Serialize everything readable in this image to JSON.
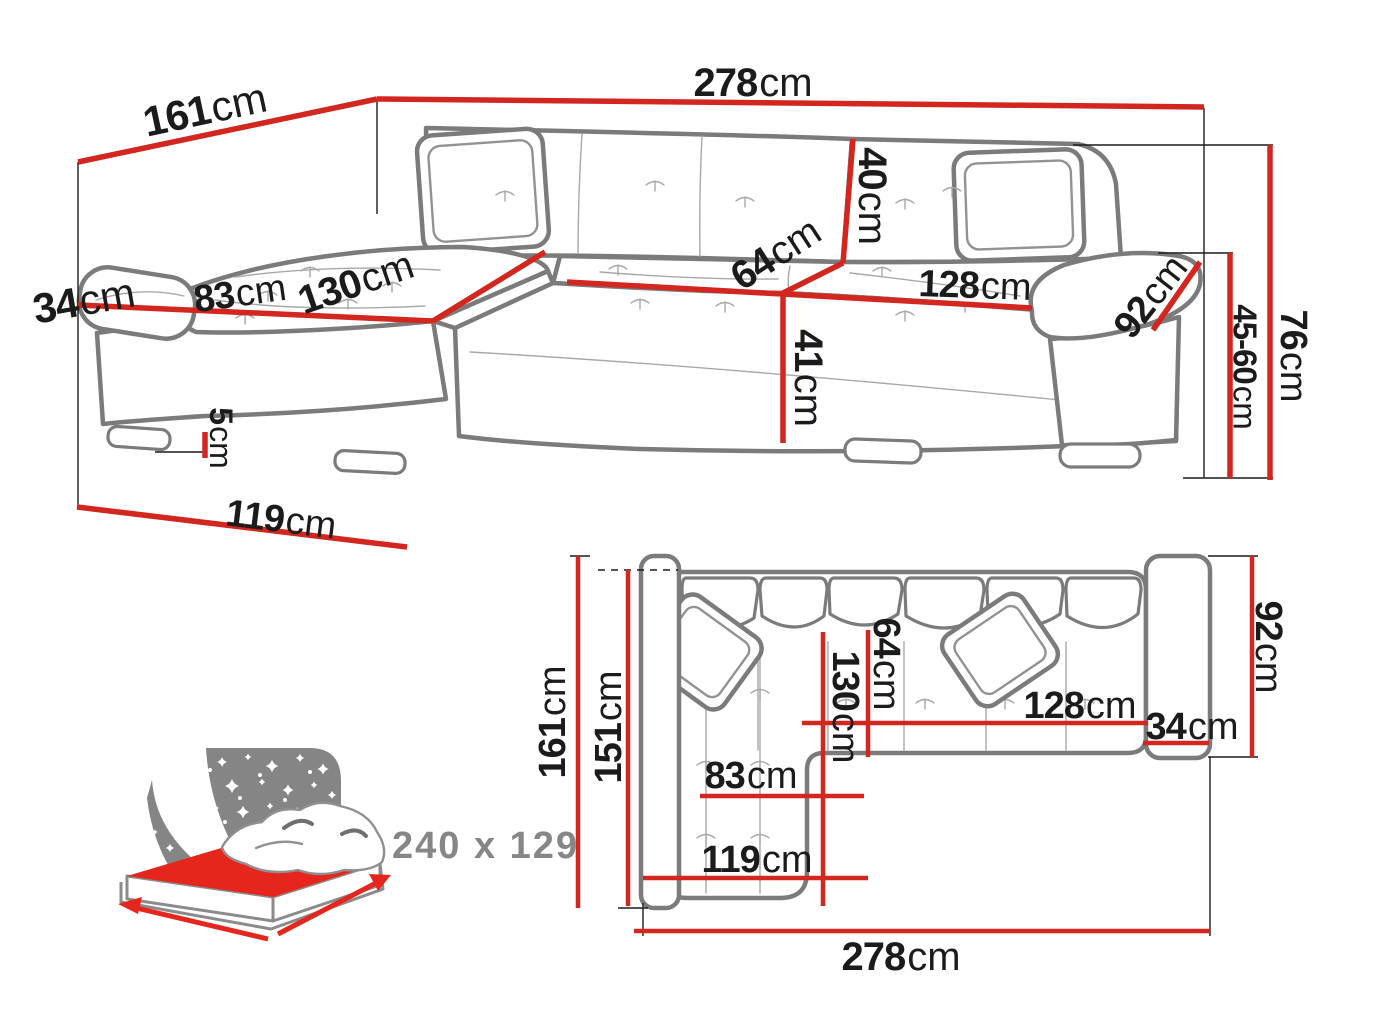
{
  "diagram_title": "corner-sofa-dimensions-diagram",
  "colors": {
    "dimension_red": "#d2261f",
    "outline_gray": "#7b7b7b",
    "seam_gray": "#a8a8a8",
    "label_black": "#1b1b1b",
    "icon_gray": "#858585",
    "icon_red": "#e6261c"
  },
  "dims_perspective": {
    "d161": {
      "num": "161",
      "unit": "cm"
    },
    "d278": {
      "num": "278",
      "unit": "cm"
    },
    "d34": {
      "num": "34",
      "unit": "cm"
    },
    "d83": {
      "num": "83",
      "unit": "cm"
    },
    "d130": {
      "num": "130",
      "unit": "cm"
    },
    "d40": {
      "num": "40",
      "unit": "cm"
    },
    "d64": {
      "num": "64",
      "unit": "cm"
    },
    "d41": {
      "num": "41",
      "unit": "cm"
    },
    "d128": {
      "num": "128",
      "unit": "cm"
    },
    "d92": {
      "num": "92",
      "unit": "cm"
    },
    "d76": {
      "num": "76",
      "unit": "cm"
    },
    "d45_60": {
      "num": "45-60",
      "unit": "cm"
    },
    "d5": {
      "num": "5",
      "unit": "cm"
    },
    "d119": {
      "num": "119",
      "unit": "cm"
    }
  },
  "dims_plan": {
    "d161": {
      "num": "161",
      "unit": "cm"
    },
    "d151": {
      "num": "151",
      "unit": "cm"
    },
    "d130": {
      "num": "130",
      "unit": "cm"
    },
    "d64": {
      "num": "64",
      "unit": "cm"
    },
    "d128": {
      "num": "128",
      "unit": "cm"
    },
    "d34": {
      "num": "34",
      "unit": "cm"
    },
    "d92": {
      "num": "92",
      "unit": "cm"
    },
    "d83": {
      "num": "83",
      "unit": "cm"
    },
    "d119": {
      "num": "119",
      "unit": "cm"
    },
    "d278": {
      "num": "278",
      "unit": "cm"
    }
  },
  "bed_icon": {
    "sleeping_area": "240 x 129"
  }
}
